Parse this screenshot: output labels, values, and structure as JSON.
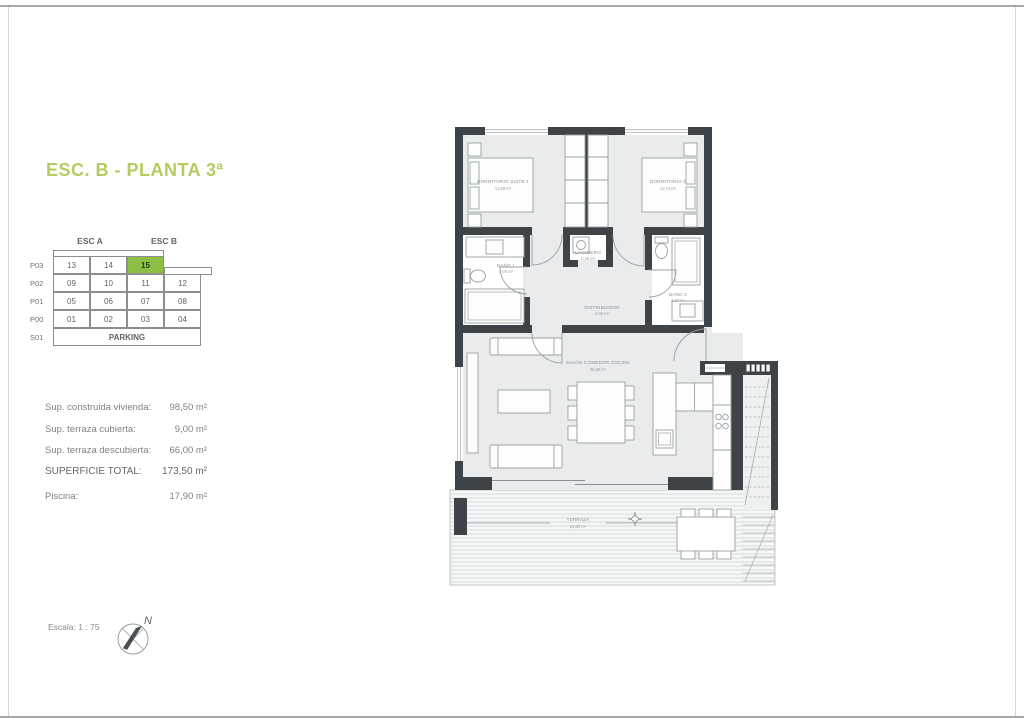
{
  "page": {
    "title": "ESC. B - PLANTA 3ª",
    "scale_label": "Escala: 1 : 75",
    "compass_label": "N"
  },
  "unit_table": {
    "col_headers": [
      "ESC A",
      "ESC B"
    ],
    "rows": [
      {
        "label": "P03",
        "cells": [
          "13",
          "14",
          "15",
          ""
        ]
      },
      {
        "label": "P02",
        "cells": [
          "09",
          "10",
          "11",
          "12"
        ]
      },
      {
        "label": "P01",
        "cells": [
          "05",
          "06",
          "07",
          "08"
        ]
      },
      {
        "label": "P00",
        "cells": [
          "01",
          "02",
          "03",
          "04"
        ]
      },
      {
        "label": "S01",
        "cells": [
          "PARKING"
        ]
      }
    ],
    "highlighted_unit": "15",
    "highlight_color": "#8cbf44"
  },
  "surfaces": {
    "rows": [
      {
        "label": "Sup. construida vivienda:",
        "value": "98,50 m²"
      },
      {
        "label": "Sup. terraza cubierta:",
        "value": "9,00 m²"
      },
      {
        "label": "Sup. terraza descubierta:",
        "value": "66,00 m²"
      },
      {
        "label": "SUPERFICIE TOTAL:",
        "value": "173,50 m²"
      },
      {
        "label": "Piscina:",
        "value": "17,90 m²"
      }
    ]
  },
  "floorplan": {
    "rooms": {
      "suite1": {
        "name": "DORMITORIO SUITE 1",
        "area": "13,68 m²"
      },
      "dorm2": {
        "name": "DORMITORIO 2",
        "area": "12,74 m²"
      },
      "bano1": {
        "name": "BAÑO 1",
        "area": "4,09 m²"
      },
      "lavadero": {
        "name": "LAVADERO",
        "area": "2,38 m²"
      },
      "distribuidor": {
        "name": "DISTRIBUIDOR",
        "area": "2,90 m²"
      },
      "bano2": {
        "name": "BAÑO 2",
        "area": "4,27 m²"
      },
      "salon": {
        "name": "SALÓN COMEDOR COCINA",
        "area": "38,89 m²"
      },
      "terraza": {
        "name": "TERRAZA",
        "area": "23,62 m²"
      }
    }
  },
  "colors": {
    "title_green": "#b3cc60",
    "accent_green": "#8cbf44",
    "wall": "#3e4347",
    "floor": "#e9ebec"
  }
}
